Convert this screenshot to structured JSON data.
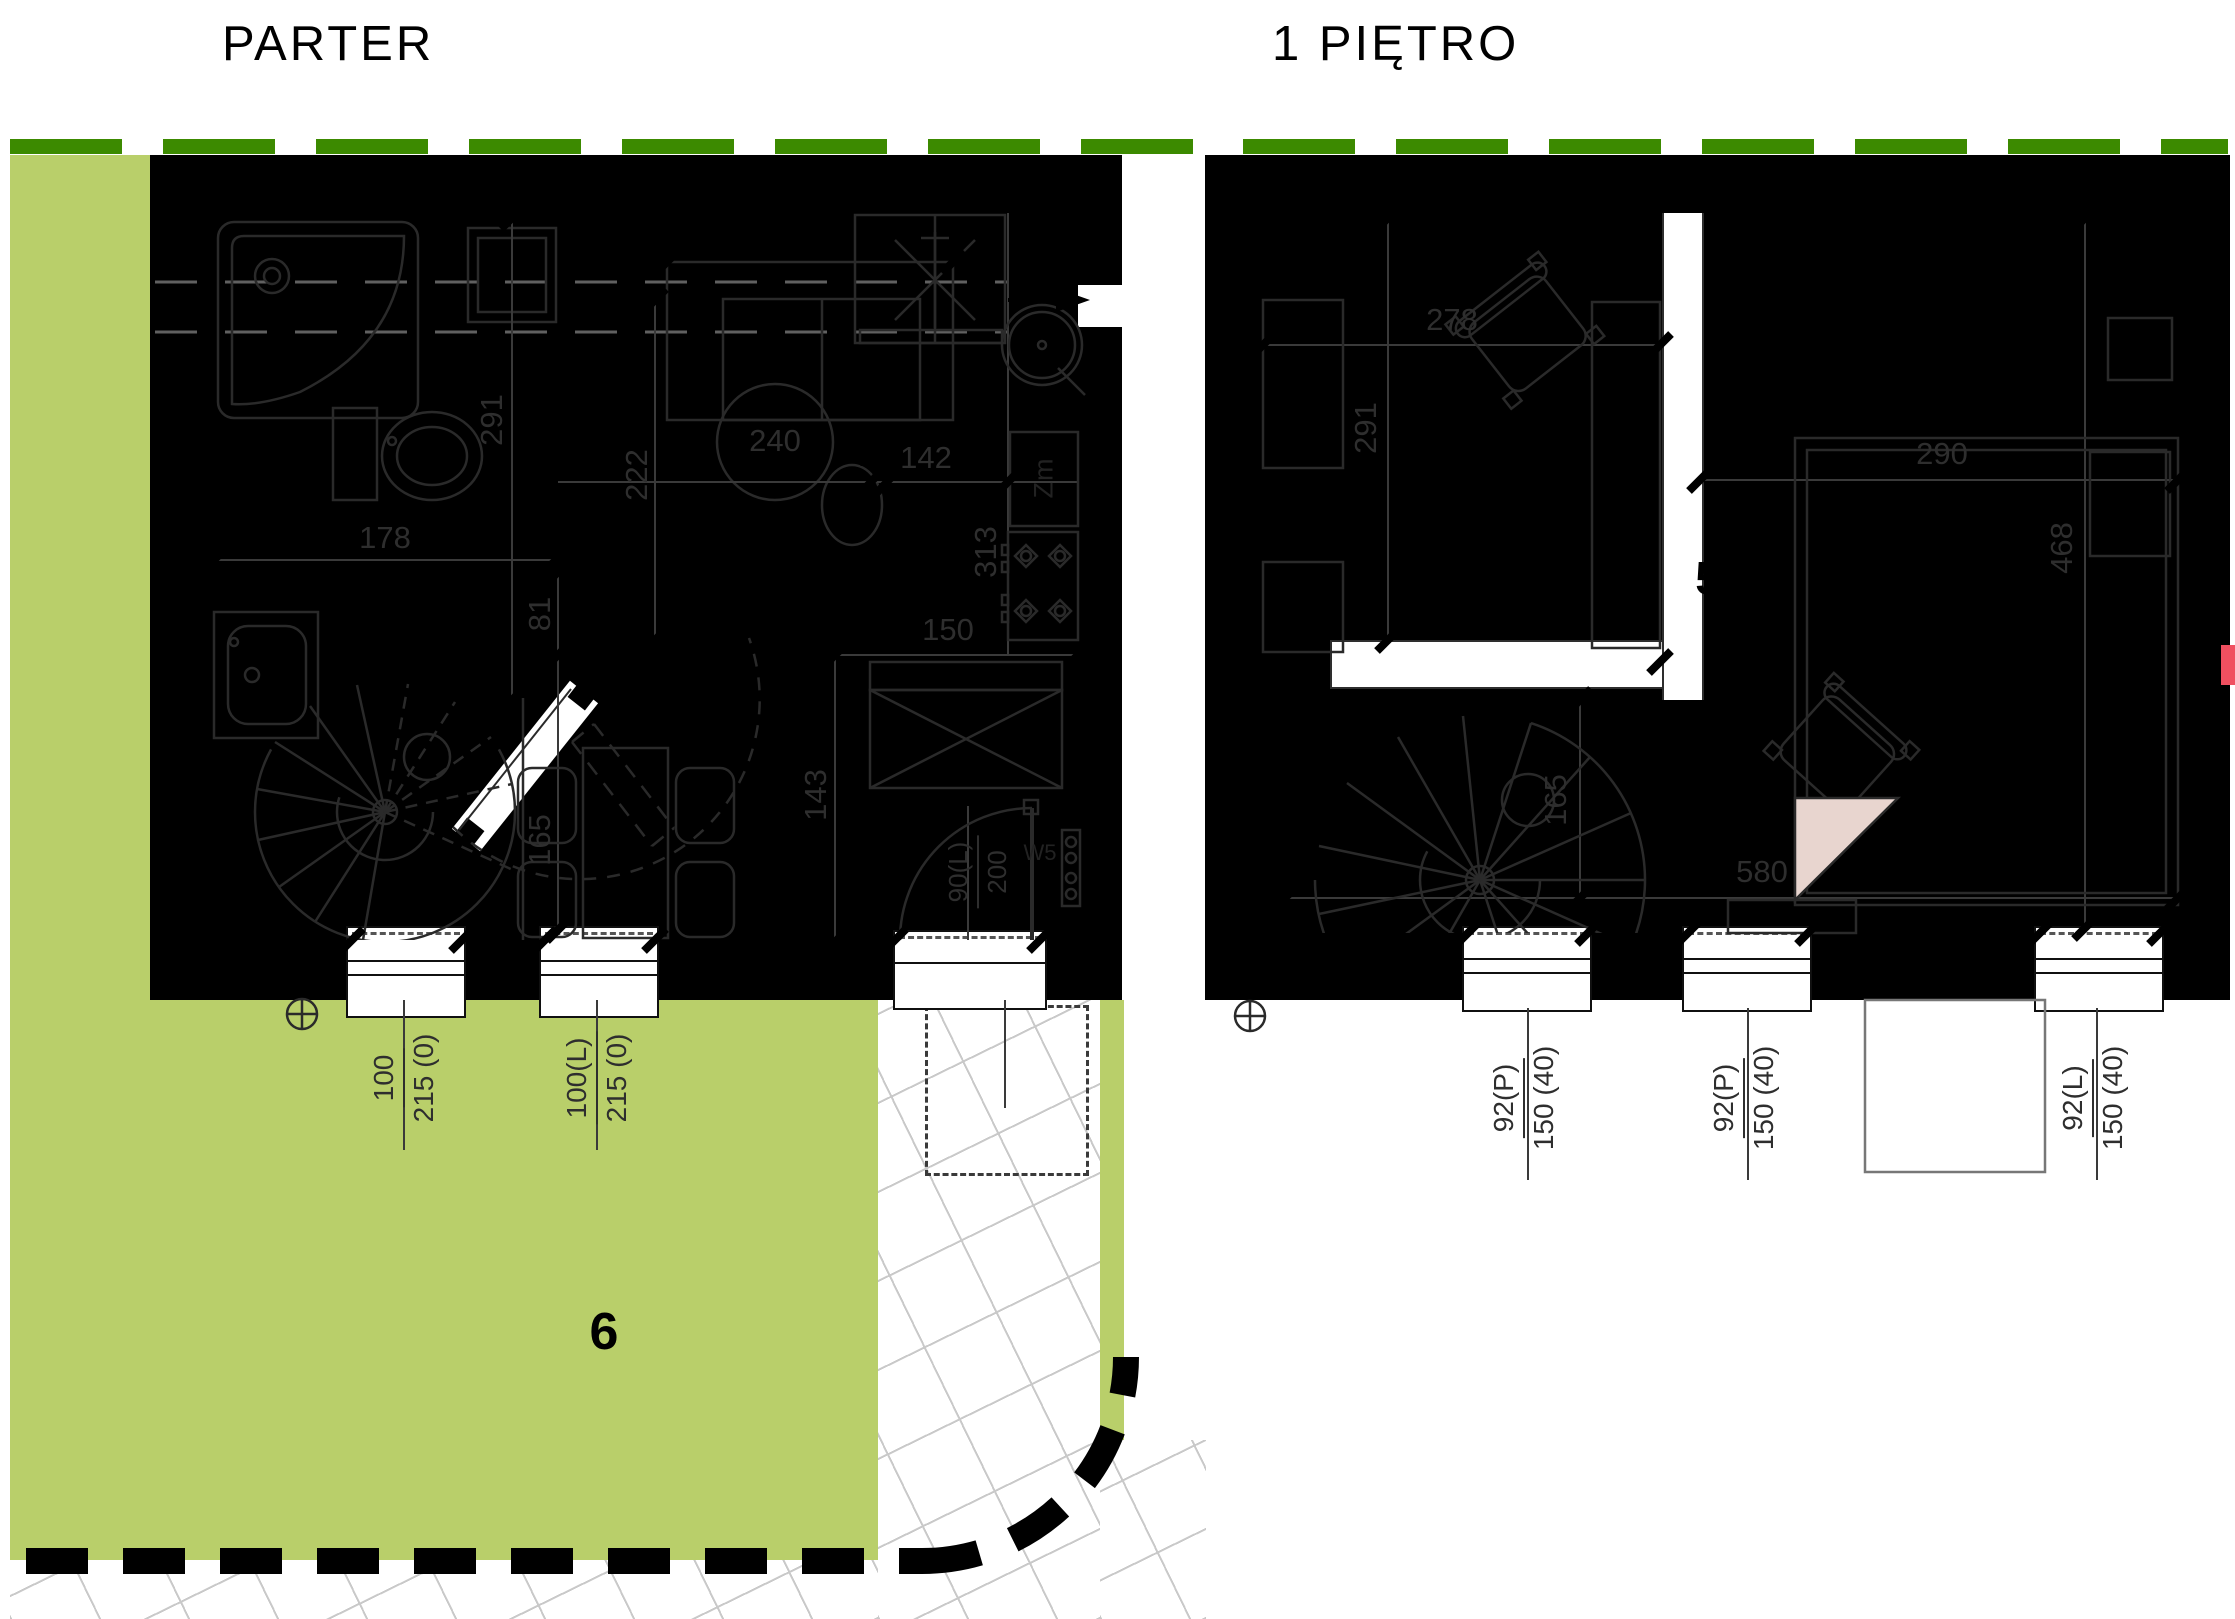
{
  "titles": {
    "left": "PARTER",
    "right": "1 PIĘTRO"
  },
  "colors": {
    "interior": "#e8d5cf",
    "bathroom": "#abccd6",
    "garden": "#b9cf6a",
    "hedge": "#3c8a00",
    "wall": "#000000",
    "accent_red": "#f05060",
    "line": "#2e2e2e",
    "paving_line": "#c9c9c9"
  },
  "parter": {
    "rooms": {
      "entry_hall": "1",
      "living": "2",
      "bathroom": "3",
      "vestibule": "5",
      "garden": "6"
    },
    "dims": {
      "bath_depth": "291",
      "bath_width": "178",
      "living_left": "222",
      "table_dia": "240",
      "kitchen_top": "142",
      "kitchen_side": "313",
      "nook": "81",
      "table_len": "165",
      "entry_len": "143",
      "kitchen_run": "150"
    },
    "appliance_zm": "Zm",
    "door_tag": "W5",
    "windows": [
      {
        "num": "100",
        "den": "215 (0)"
      },
      {
        "num": "100(L)",
        "den": "215 (0)"
      }
    ],
    "door": {
      "num": "90(L)",
      "den": "200"
    }
  },
  "pietro": {
    "rooms": {
      "study": "4",
      "bedroom": "5"
    },
    "dims": {
      "study_width": "278",
      "study_depth": "291",
      "bed_width": "290",
      "room_depth": "468",
      "stair_len": "165",
      "floor_width": "580"
    },
    "windows": [
      {
        "num": "92(P)",
        "den": "150 (40)"
      },
      {
        "num": "92(P)",
        "den": "150 (40)"
      },
      {
        "num": "92(L)",
        "den": "150 (40)"
      }
    ]
  }
}
